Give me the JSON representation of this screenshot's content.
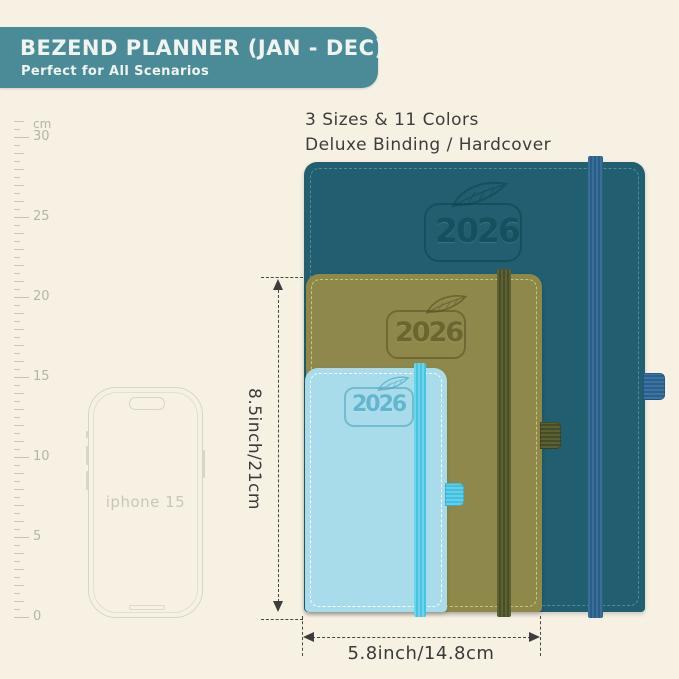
{
  "page": {
    "background_color": "#f6f1e3"
  },
  "banner": {
    "title": "BEZEND PLANNER (JAN - DEC)",
    "subtitle": "Perfect for All Scenarios",
    "bg_color": "#4b8b97",
    "text_color": "#eff4f0"
  },
  "info": {
    "line1": "3 Sizes & 11 Colors",
    "line2": "Deluxe Binding / Hardcover"
  },
  "ruler": {
    "unit": "cm",
    "px_per_cm": 16,
    "max_cm": 31,
    "major_labels": [
      30,
      25,
      20,
      15,
      10,
      5,
      0
    ]
  },
  "phone": {
    "label": "iphone 15"
  },
  "planners": [
    {
      "size": "large",
      "year": "2026",
      "cover_color": "#215f70",
      "band_color": "#32688f"
    },
    {
      "size": "medium",
      "year": "2026",
      "cover_color": "#8e894a",
      "band_color": "#565b30"
    },
    {
      "size": "small",
      "year": "2026",
      "cover_color": "#a9dcea",
      "band_color": "#57cde9"
    }
  ],
  "dimensions": {
    "height_label": "8.5inch/21cm",
    "width_label": "5.8inch/14.8cm"
  }
}
